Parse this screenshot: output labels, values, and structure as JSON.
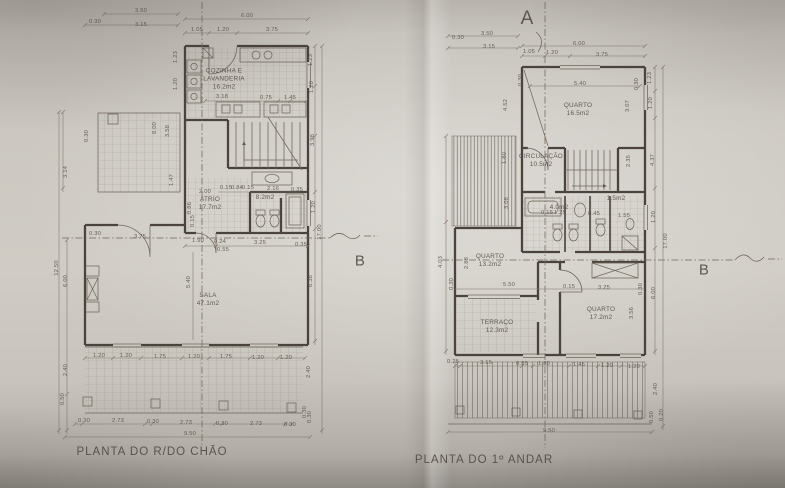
{
  "colors": {
    "paper": "#c7c3bc",
    "line": "#6e665b",
    "wall": "#4a443c",
    "dim": "#7e7669",
    "ink": "#565047"
  },
  "plans": {
    "ground": {
      "title": "PLANTA DO R/DO CHÃO",
      "section_letter_b": "B",
      "rooms": [
        {
          "lines": [
            "COZINHA E",
            "LAVANDERIA",
            "16.2m2"
          ],
          "x": 224,
          "y": 80
        },
        {
          "lines": [
            "ATRIO",
            "17.7m2"
          ],
          "x": 210,
          "y": 204
        },
        {
          "lines": [
            "8.2m2"
          ],
          "x": 265,
          "y": 198
        },
        {
          "lines": [
            "SALA",
            "47.1m2"
          ],
          "x": 208,
          "y": 300
        }
      ],
      "dimensions": [
        {
          "t": "3.50",
          "x": 141,
          "y": 11
        },
        {
          "t": "0.30",
          "x": 95,
          "y": 22
        },
        {
          "t": "3.15",
          "x": 141,
          "y": 25
        },
        {
          "t": "6.00",
          "x": 247,
          "y": 16
        },
        {
          "t": "1.05",
          "x": 197,
          "y": 30
        },
        {
          "t": "1.20",
          "x": 223,
          "y": 30
        },
        {
          "t": "3.75",
          "x": 272,
          "y": 30
        },
        {
          "t": "1.23",
          "x": 176,
          "y": 57,
          "r": -90
        },
        {
          "t": "1.20",
          "x": 176,
          "y": 84,
          "r": -90
        },
        {
          "t": "3.18",
          "x": 222,
          "y": 97
        },
        {
          "t": "0.75",
          "x": 266,
          "y": 98
        },
        {
          "t": "1.45",
          "x": 290,
          "y": 98
        },
        {
          "t": "1.23",
          "x": 311,
          "y": 60,
          "r": -90
        },
        {
          "t": "1.20",
          "x": 312,
          "y": 87,
          "r": -90
        },
        {
          "t": "0.30",
          "x": 87,
          "y": 136,
          "r": -90
        },
        {
          "t": "3.14",
          "x": 66,
          "y": 172,
          "r": -90
        },
        {
          "t": "8.00",
          "x": 155,
          "y": 128,
          "r": -90
        },
        {
          "t": "3.58",
          "x": 168,
          "y": 131,
          "r": -90
        },
        {
          "t": "12.50",
          "x": 57,
          "y": 268,
          "r": -90
        },
        {
          "t": "6.00",
          "x": 66,
          "y": 281,
          "r": -90
        },
        {
          "t": "2.40",
          "x": 66,
          "y": 370,
          "r": -90
        },
        {
          "t": "0.50",
          "x": 63,
          "y": 399,
          "r": -90
        },
        {
          "t": "1.47",
          "x": 172,
          "y": 180,
          "r": -90
        },
        {
          "t": "0.86",
          "x": 190,
          "y": 208,
          "r": -90
        },
        {
          "t": "0.15",
          "x": 193,
          "y": 221,
          "r": -90
        },
        {
          "t": "2.00",
          "x": 205,
          "y": 192
        },
        {
          "t": "0.15",
          "x": 226,
          "y": 188
        },
        {
          "t": "0.84",
          "x": 237,
          "y": 188
        },
        {
          "t": "0.15",
          "x": 248,
          "y": 188
        },
        {
          "t": "2.16",
          "x": 273,
          "y": 189
        },
        {
          "t": "0.35",
          "x": 297,
          "y": 190
        },
        {
          "t": "0.30",
          "x": 95,
          "y": 234
        },
        {
          "t": "3.75",
          "x": 140,
          "y": 237
        },
        {
          "t": "1.90",
          "x": 198,
          "y": 241
        },
        {
          "t": "0.24",
          "x": 220,
          "y": 242
        },
        {
          "t": "0.55",
          "x": 223,
          "y": 250
        },
        {
          "t": "3.25",
          "x": 260,
          "y": 243
        },
        {
          "t": "0.35",
          "x": 301,
          "y": 245
        },
        {
          "t": "3.98",
          "x": 313,
          "y": 140,
          "r": -90
        },
        {
          "t": "1.20",
          "x": 314,
          "y": 207,
          "r": -90
        },
        {
          "t": "17.00",
          "x": 320,
          "y": 232,
          "r": -90
        },
        {
          "t": "6.38",
          "x": 311,
          "y": 281,
          "r": -90
        },
        {
          "t": "5.40",
          "x": 189,
          "y": 282,
          "r": -90
        },
        {
          "t": "1.20",
          "x": 99,
          "y": 356
        },
        {
          "t": "1.20",
          "x": 126,
          "y": 356
        },
        {
          "t": "1.75",
          "x": 160,
          "y": 357
        },
        {
          "t": "1.20",
          "x": 194,
          "y": 357
        },
        {
          "t": "1.75",
          "x": 226,
          "y": 357
        },
        {
          "t": "1.20",
          "x": 258,
          "y": 358
        },
        {
          "t": "1.20",
          "x": 286,
          "y": 358
        },
        {
          "t": "2.40",
          "x": 309,
          "y": 372,
          "r": -90
        },
        {
          "t": "0.30",
          "x": 305,
          "y": 412,
          "r": -90
        },
        {
          "t": "0.30",
          "x": 310,
          "y": 417,
          "r": -90
        },
        {
          "t": "0.30",
          "x": 84,
          "y": 421
        },
        {
          "t": "2.73",
          "x": 118,
          "y": 421
        },
        {
          "t": "0.30",
          "x": 153,
          "y": 422
        },
        {
          "t": "2.73",
          "x": 186,
          "y": 423
        },
        {
          "t": "0.30",
          "x": 222,
          "y": 424
        },
        {
          "t": "2.73",
          "x": 256,
          "y": 424
        },
        {
          "t": "0.30",
          "x": 290,
          "y": 425
        },
        {
          "t": "9.50",
          "x": 190,
          "y": 434
        }
      ]
    },
    "first": {
      "title": "PLANTA DO 1º ANDAR",
      "section_letter_a": "A",
      "section_letter_b": "B",
      "rooms": [
        {
          "lines": [
            "QUARTO",
            "16.5m2"
          ],
          "x": 578,
          "y": 110
        },
        {
          "lines": [
            "CIRCULAÇÃO",
            "10.5m2"
          ],
          "x": 541,
          "y": 161
        },
        {
          "lines": [
            "4.0m2"
          ],
          "x": 559,
          "y": 208
        },
        {
          "lines": [
            "1.5m2"
          ],
          "x": 616,
          "y": 199
        },
        {
          "lines": [
            "QUARTO",
            "13.2m2"
          ],
          "x": 490,
          "y": 261
        },
        {
          "lines": [
            "TERRAÇO",
            "12.3m2"
          ],
          "x": 497,
          "y": 327
        },
        {
          "lines": [
            "QUARTO",
            "17.2m2"
          ],
          "x": 601,
          "y": 314
        }
      ],
      "dimensions": [
        {
          "t": "3.50",
          "x": 487,
          "y": 34
        },
        {
          "t": "0.30",
          "x": 458,
          "y": 38
        },
        {
          "t": "3.15",
          "x": 489,
          "y": 47
        },
        {
          "t": "6.00",
          "x": 579,
          "y": 44
        },
        {
          "t": "1.05",
          "x": 529,
          "y": 52
        },
        {
          "t": "1.20",
          "x": 552,
          "y": 53
        },
        {
          "t": "3.75",
          "x": 602,
          "y": 55
        },
        {
          "t": "5.40",
          "x": 580,
          "y": 84
        },
        {
          "t": "0.30",
          "x": 521,
          "y": 80,
          "r": -90
        },
        {
          "t": "0.30",
          "x": 637,
          "y": 84,
          "r": -90
        },
        {
          "t": "1.23",
          "x": 650,
          "y": 78,
          "r": -90
        },
        {
          "t": "1.20",
          "x": 651,
          "y": 103,
          "r": -90
        },
        {
          "t": "3.07",
          "x": 628,
          "y": 106,
          "r": -90
        },
        {
          "t": "4.52",
          "x": 506,
          "y": 105,
          "r": -90
        },
        {
          "t": "1.80",
          "x": 505,
          "y": 158,
          "r": -90
        },
        {
          "t": "3.08",
          "x": 507,
          "y": 203,
          "r": -90
        },
        {
          "t": "4.03",
          "x": 441,
          "y": 262,
          "r": -90
        },
        {
          "t": "2.35",
          "x": 629,
          "y": 161,
          "r": -90
        },
        {
          "t": "4.37",
          "x": 653,
          "y": 160,
          "r": -90
        },
        {
          "t": "1.20",
          "x": 654,
          "y": 217,
          "r": -90
        },
        {
          "t": "17.00",
          "x": 666,
          "y": 241,
          "r": -90
        },
        {
          "t": "0.15",
          "x": 547,
          "y": 213
        },
        {
          "t": "1.25",
          "x": 560,
          "y": 213
        },
        {
          "t": "0.45",
          "x": 594,
          "y": 214
        },
        {
          "t": "1.55",
          "x": 624,
          "y": 216
        },
        {
          "t": "2.88",
          "x": 467,
          "y": 263,
          "r": -90
        },
        {
          "t": "5.50",
          "x": 509,
          "y": 285
        },
        {
          "t": "0.15",
          "x": 569,
          "y": 287
        },
        {
          "t": "3.25",
          "x": 604,
          "y": 288
        },
        {
          "t": "0.30",
          "x": 641,
          "y": 289,
          "r": -90
        },
        {
          "t": "0.30",
          "x": 452,
          "y": 284,
          "r": -90
        },
        {
          "t": "6.00",
          "x": 654,
          "y": 293,
          "r": -90
        },
        {
          "t": "3.56",
          "x": 632,
          "y": 313,
          "r": -90
        },
        {
          "t": "0.25",
          "x": 453,
          "y": 362
        },
        {
          "t": "3.15",
          "x": 486,
          "y": 363
        },
        {
          "t": "0.55",
          "x": 522,
          "y": 364
        },
        {
          "t": "1.80",
          "x": 544,
          "y": 364
        },
        {
          "t": "1.45",
          "x": 579,
          "y": 365
        },
        {
          "t": "1.20",
          "x": 607,
          "y": 366
        },
        {
          "t": "1.20",
          "x": 634,
          "y": 367
        },
        {
          "t": "2.40",
          "x": 656,
          "y": 389,
          "r": -90
        },
        {
          "t": "0.50",
          "x": 652,
          "y": 417,
          "r": -90
        },
        {
          "t": "0.20",
          "x": 662,
          "y": 415,
          "r": -90
        },
        {
          "t": "9.50",
          "x": 549,
          "y": 431
        }
      ]
    }
  }
}
